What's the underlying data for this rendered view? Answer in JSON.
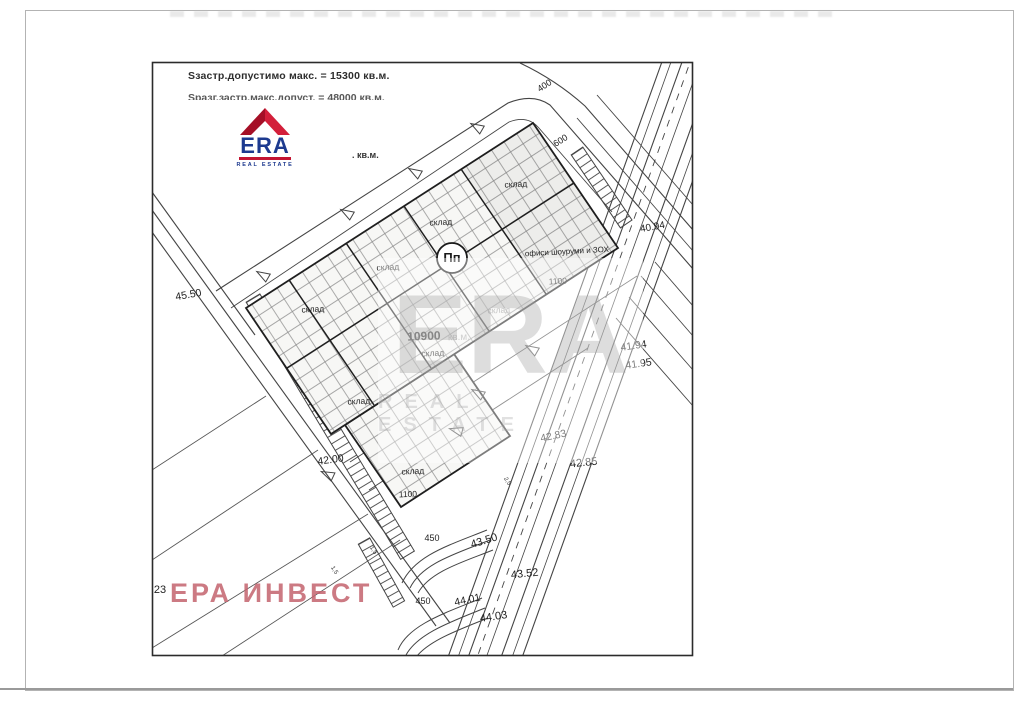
{
  "header": {
    "line1": "Sзастр.допустимо макс. = 15300 кв.м.",
    "line2_clipped": "Sразг.застр.макс.допуст. = 48000 кв.м.",
    "kvm_fragment": ". кв.м."
  },
  "logo": {
    "word": "ERA",
    "subtitle": "REAL ESTATE",
    "red": "#c31432",
    "navy": "#1d3a8f"
  },
  "watermark": {
    "word": "ERA",
    "subtitle": "REAL ESTATE"
  },
  "invest_mark": {
    "text": "ЕРА ИНВЕСТ",
    "color": "#c4636e"
  },
  "plan": {
    "building_symbol": "Пп",
    "total_area": {
      "value": "10900",
      "unit": "кв.м."
    },
    "labels": [
      {
        "text": "склад",
        "x": 516,
        "y": 187,
        "size": 8.5,
        "rot": -3,
        "color": "#222"
      },
      {
        "text": "склад",
        "x": 441,
        "y": 225,
        "size": 8.5,
        "rot": -3,
        "color": "#222"
      },
      {
        "text": "склад",
        "x": 388,
        "y": 270,
        "size": 8.5,
        "rot": -3,
        "color": "#222"
      },
      {
        "text": "склад",
        "x": 313,
        "y": 312,
        "size": 8.5,
        "rot": -3,
        "color": "#222"
      },
      {
        "text": "склад",
        "x": 499,
        "y": 313,
        "size": 8.5,
        "rot": -3,
        "color": "#9a9a9a"
      },
      {
        "text": "склад",
        "x": 433,
        "y": 356,
        "size": 8.5,
        "rot": -3,
        "color": "#222"
      },
      {
        "text": "склад",
        "x": 359,
        "y": 404,
        "size": 8.5,
        "rot": -3,
        "color": "#222"
      },
      {
        "text": "склад",
        "x": 413,
        "y": 474,
        "size": 8.5,
        "rot": -3,
        "color": "#222"
      },
      {
        "text": "офиси шоуруми и ЗОХ",
        "x": 567,
        "y": 254,
        "size": 8,
        "rot": -3,
        "color": "#222"
      },
      {
        "text": "1100",
        "x": 558,
        "y": 284,
        "size": 8.5,
        "rot": -3,
        "color": "#222"
      },
      {
        "text": "1100",
        "x": 408,
        "y": 497,
        "size": 8.5,
        "rot": -2,
        "color": "#222"
      },
      {
        "text": "10900",
        "x": 424,
        "y": 340,
        "size": 12,
        "rot": -2,
        "color": "#1c1c1c",
        "bold": true
      },
      {
        "text": "кв.м.",
        "x": 459,
        "y": 340,
        "size": 10,
        "rot": -2,
        "color": "#ababab"
      },
      {
        "text": "400",
        "x": 546,
        "y": 88,
        "size": 9,
        "rot": -33,
        "color": "#222"
      },
      {
        "text": "600",
        "x": 562,
        "y": 143,
        "size": 9,
        "rot": -32,
        "color": "#222"
      },
      {
        "text": "40.94",
        "x": 653,
        "y": 230,
        "size": 10,
        "rot": -10,
        "color": "#222"
      },
      {
        "text": "41.94",
        "x": 634,
        "y": 349,
        "size": 10.5,
        "rot": -8,
        "color": "#222"
      },
      {
        "text": "41.95",
        "x": 639,
        "y": 367,
        "size": 10.5,
        "rot": -8,
        "color": "#222"
      },
      {
        "text": "42.83",
        "x": 554,
        "y": 439,
        "size": 10.5,
        "rot": -12,
        "color": "#222"
      },
      {
        "text": "42.85",
        "x": 584,
        "y": 466,
        "size": 11,
        "rot": -6,
        "color": "#222"
      },
      {
        "text": "43.50",
        "x": 485,
        "y": 544,
        "size": 11,
        "rot": -17,
        "color": "#222"
      },
      {
        "text": "43.52",
        "x": 525,
        "y": 577,
        "size": 11,
        "rot": -6,
        "color": "#222"
      },
      {
        "text": "44.01",
        "x": 468,
        "y": 603,
        "size": 10.5,
        "rot": -12,
        "color": "#222"
      },
      {
        "text": "44.03",
        "x": 494,
        "y": 620,
        "size": 11,
        "rot": -8,
        "color": "#222"
      },
      {
        "text": "45.50",
        "x": 189,
        "y": 298,
        "size": 10.5,
        "rot": -10,
        "color": "#222"
      },
      {
        "text": "42.00",
        "x": 331,
        "y": 463,
        "size": 10.5,
        "rot": -8,
        "color": "#222"
      },
      {
        "text": "450",
        "x": 432,
        "y": 541,
        "size": 9,
        "rot": 0,
        "color": "#222"
      },
      {
        "text": "450",
        "x": 423,
        "y": 604,
        "size": 9,
        "rot": 0,
        "color": "#222"
      },
      {
        "text": "1,5",
        "x": 333,
        "y": 571,
        "size": 6,
        "rot": 58,
        "color": "#333"
      },
      {
        "text": "1,5",
        "x": 372,
        "y": 551,
        "size": 6,
        "rot": 58,
        "color": "#333"
      },
      {
        "text": "2,5",
        "x": 506,
        "y": 482,
        "size": 6,
        "rot": 58,
        "color": "#333"
      },
      {
        "text": "23",
        "x": 160,
        "y": 593,
        "size": 11,
        "rot": 0,
        "color": "#222"
      },
      {
        "text": "Пп",
        "x": 452,
        "y": 262,
        "size": 13,
        "rot": 0,
        "color": "#1a1a1a",
        "bold": true
      }
    ],
    "arrows": [
      {
        "x": 482,
        "y": 130,
        "rot": 210
      },
      {
        "x": 420,
        "y": 175,
        "rot": 210
      },
      {
        "x": 352,
        "y": 216,
        "rot": 210
      },
      {
        "x": 268,
        "y": 278,
        "rot": 210
      },
      {
        "x": 537,
        "y": 352,
        "rot": 210
      },
      {
        "x": 483,
        "y": 396,
        "rot": 210
      },
      {
        "x": 333,
        "y": 477,
        "rot": 205
      },
      {
        "x": 462,
        "y": 432,
        "rot": 195
      }
    ],
    "line_color": "#444444",
    "grid_color": "#8a8a8a"
  }
}
